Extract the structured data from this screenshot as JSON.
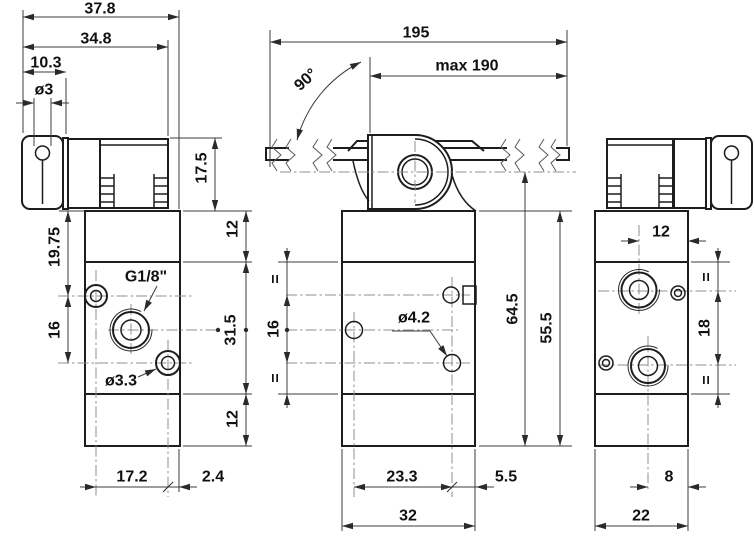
{
  "colors": {
    "background": "#ffffff",
    "object_line": "#1d1d1d",
    "dimension_line": "#3c3c3c",
    "centerline": "#8f8f8f",
    "text": "#111111"
  },
  "views": {
    "side_left": {
      "dims": {
        "overall_width": "37.8",
        "head_width": "34.8",
        "roller_width": "10.3",
        "roller_pin": "ø3",
        "head_height": "17.5",
        "top_to_port_row": "19.75",
        "port_row_spacing": "16",
        "thread_label": "G1/8\"",
        "hole_label": "ø3.3",
        "section_top": "12",
        "section_middle": "31.5",
        "section_bottom": "12",
        "port_offset": "17.2",
        "edge_offset": "2.4"
      }
    },
    "front": {
      "dims": {
        "lever_overall": "195",
        "lever_max": "max 190",
        "lever_angle": "90°",
        "equal_top": "=",
        "hole_row_spacing": "16",
        "equal_bottom": "=",
        "hole_label": "ø4.2",
        "lever_axis_height": "64.5",
        "body_height": "55.5",
        "hole_spacing": "23.3",
        "hole_edge_offset": "5.5",
        "body_width": "32"
      }
    },
    "side_right": {
      "dims": {
        "port_to_edge": "12",
        "equal_top": "=",
        "port_row_spacing": "18",
        "equal_bottom": "=",
        "bottom_port_to_edge": "8",
        "body_depth": "22"
      }
    }
  }
}
